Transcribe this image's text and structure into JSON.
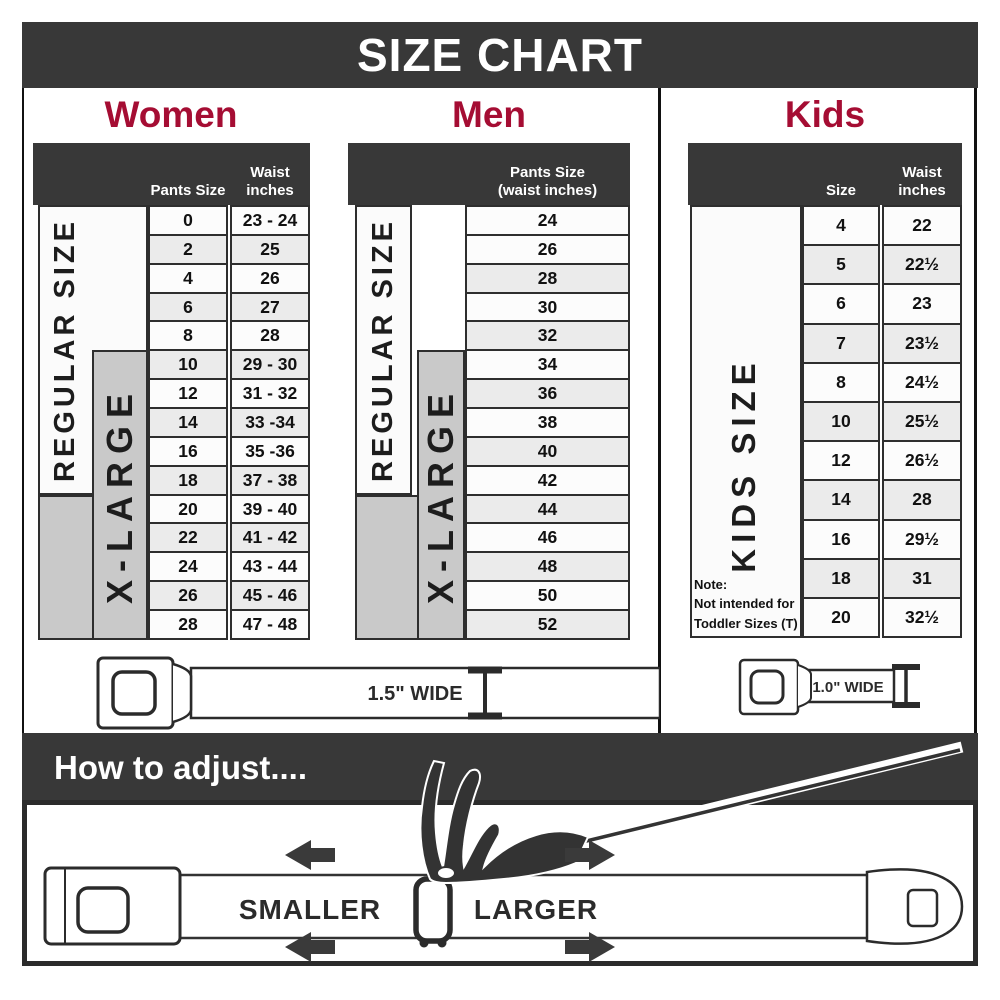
{
  "title": "SIZE CHART",
  "colors": {
    "dark": "#383838",
    "header_red": "#A50D33",
    "row_alt": "#ebebeb",
    "xl_gray": "#c9c9c9",
    "border": "#2e2e2e"
  },
  "women": {
    "title": "Women",
    "col1": "Pants Size",
    "col2_line1": "Waist",
    "col2_line2": "inches",
    "regular_label": "REGULAR SIZE",
    "xlarge_label": "X-LARGE",
    "rows": [
      {
        "size": "0",
        "waist": "23 - 24"
      },
      {
        "size": "2",
        "waist": "25"
      },
      {
        "size": "4",
        "waist": "26"
      },
      {
        "size": "6",
        "waist": "27"
      },
      {
        "size": "8",
        "waist": "28"
      },
      {
        "size": "10",
        "waist": "29 - 30"
      },
      {
        "size": "12",
        "waist": "31 - 32"
      },
      {
        "size": "14",
        "waist": "33 -34"
      },
      {
        "size": "16",
        "waist": "35 -36"
      },
      {
        "size": "18",
        "waist": "37 - 38"
      },
      {
        "size": "20",
        "waist": "39 - 40"
      },
      {
        "size": "22",
        "waist": "41 - 42"
      },
      {
        "size": "24",
        "waist": "43 - 44"
      },
      {
        "size": "26",
        "waist": "45 - 46"
      },
      {
        "size": "28",
        "waist": "47 - 48"
      }
    ]
  },
  "men": {
    "title": "Men",
    "col_line1": "Pants Size",
    "col_line2": "(waist inches)",
    "regular_label": "REGULAR SIZE",
    "xlarge_label": "X-LARGE",
    "rows": [
      "24",
      "26",
      "28",
      "30",
      "32",
      "34",
      "36",
      "38",
      "40",
      "42",
      "44",
      "46",
      "48",
      "50",
      "52"
    ]
  },
  "kids": {
    "title": "Kids",
    "col1": "Size",
    "col2_line1": "Waist",
    "col2_line2": "inches",
    "label": "KIDS SIZE",
    "note_line1": "Note:",
    "note_line2": "Not intended for",
    "note_line3": "Toddler Sizes (T)",
    "rows": [
      {
        "size": "4",
        "waist": "22"
      },
      {
        "size": "5",
        "waist": "22½"
      },
      {
        "size": "6",
        "waist": "23"
      },
      {
        "size": "7",
        "waist": "23½"
      },
      {
        "size": "8",
        "waist": "24½"
      },
      {
        "size": "10",
        "waist": "25½"
      },
      {
        "size": "12",
        "waist": "26½"
      },
      {
        "size": "14",
        "waist": "28"
      },
      {
        "size": "16",
        "waist": "29½"
      },
      {
        "size": "18",
        "waist": "31"
      },
      {
        "size": "20",
        "waist": "32½"
      }
    ]
  },
  "belts": {
    "adult_width": "1.5\" WIDE",
    "kids_width": "1.0\" WIDE"
  },
  "adjust": {
    "title": "How to adjust....",
    "smaller": "SMALLER",
    "larger": "LARGER"
  }
}
